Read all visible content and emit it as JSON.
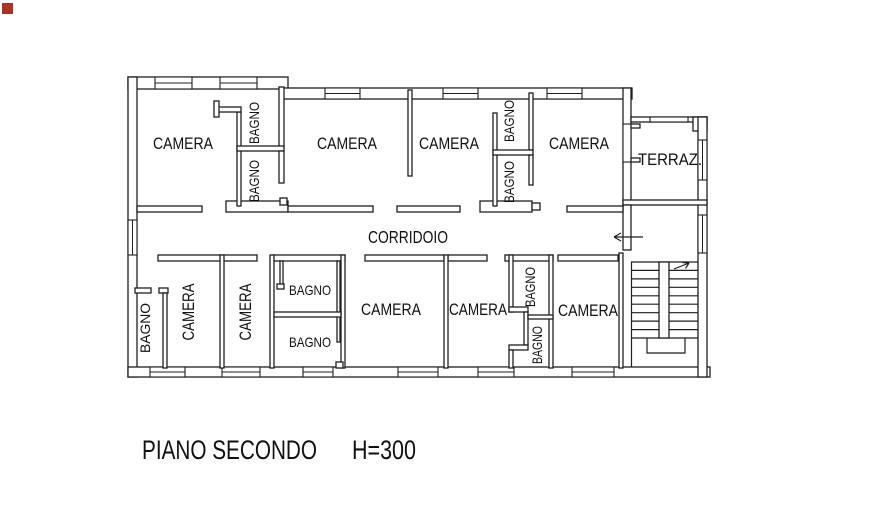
{
  "colors": {
    "background": "#ffffff",
    "wall_line": "#1f1f1f",
    "text": "#111111",
    "marker": "#a93226"
  },
  "labels": {
    "camera_top_1": "CAMERA",
    "bagno_top_1a": "BAGNO",
    "bagno_top_1b": "BAGNO",
    "camera_top_2": "CAMERA",
    "camera_top_3": "CAMERA",
    "bagno_top_2a": "BAGNO",
    "bagno_top_2b": "BAGNO",
    "camera_top_4": "CAMERA",
    "terrace": "TERRAZ.",
    "corridor": "CORRIDOIO",
    "bagno_bottom_left": "BAGNO",
    "camera_bottom_1": "CAMERA",
    "camera_bottom_2": "CAMERA",
    "bagno_bottom_mid_upper": "BAGNO",
    "bagno_bottom_mid_lower": "BAGNO",
    "camera_bottom_3": "CAMERA",
    "camera_bottom_4": "CAMERA",
    "bagno_bottom_right_upper": "BAGNO",
    "bagno_bottom_right_lower": "BAGNO",
    "camera_bottom_5": "CAMERA",
    "floor_title": "PIANO SECONDO",
    "height_note": "H=300"
  }
}
